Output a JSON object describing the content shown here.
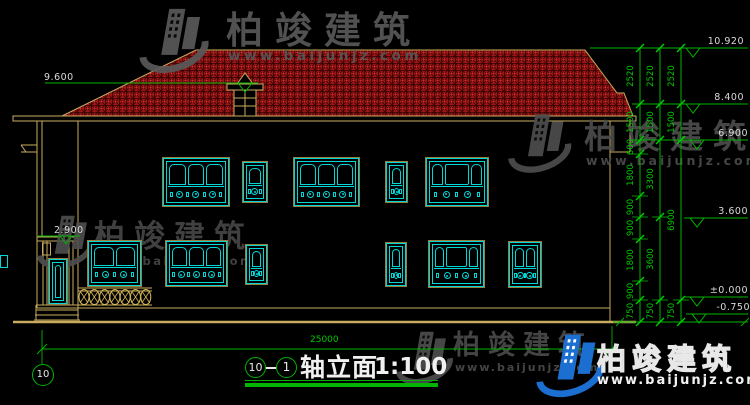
{
  "watermark": {
    "name": "柏竣建筑",
    "url": "www.baijunjz.com"
  },
  "title": {
    "axis_start": "10",
    "axis_end": "1",
    "name": "轴立面",
    "scale": "1:100"
  },
  "axis_bubble": "10",
  "bottom_dim": "25000",
  "colors": {
    "dim_green": "#00c800",
    "cyan": "#00d8d8",
    "tan": "#c8ab5e",
    "roof_red": "#9c1414",
    "wm_blue": "#1b6fd0"
  },
  "elevations_right": [
    {
      "label": "10.920",
      "x1": 680,
      "x2": 748,
      "y": 48
    },
    {
      "label": "8.400",
      "x1": 680,
      "x2": 748,
      "y": 104
    },
    {
      "label": "6.900",
      "x1": 684,
      "x2": 748,
      "y": 140
    },
    {
      "label": "3.600",
      "x1": 684,
      "x2": 748,
      "y": 218
    },
    {
      "label": "±0.000",
      "x1": 684,
      "x2": 748,
      "y": 297
    },
    {
      "label": "-0.750",
      "x1": 686,
      "x2": 748,
      "y": 314
    }
  ],
  "elevations_left": [
    {
      "label": "9.600",
      "x1": 45,
      "x2": 258,
      "y": 83,
      "tri": 238,
      "tx": 44,
      "tw": 14
    },
    {
      "label": "2.900",
      "x1": 38,
      "x2": 80,
      "y": 236,
      "tri": 60,
      "tx": 54,
      "tw": 12
    }
  ],
  "dim_columns": [
    {
      "x": 640,
      "boundaries": [
        48,
        104,
        140,
        154,
        196,
        217,
        239,
        281,
        300,
        322
      ],
      "labels": [
        "2520",
        "1500",
        "600",
        "1800",
        "900",
        "900",
        "1800",
        "900",
        "750"
      ]
    },
    {
      "x": 660,
      "boundaries": [
        48,
        104,
        140,
        217,
        300,
        322
      ],
      "labels": [
        "2520",
        "1500",
        "3300",
        "3600",
        "750"
      ]
    },
    {
      "x": 681,
      "boundaries": [
        48,
        104,
        140,
        300,
        322
      ],
      "labels": [
        "2520",
        "1500",
        "6900",
        "750"
      ]
    }
  ],
  "windows": [
    {
      "id": "u1",
      "style": "wide3",
      "x": 162,
      "y": 157,
      "w": 68,
      "h": 50
    },
    {
      "id": "u2",
      "style": "narrow",
      "x": 242,
      "y": 161,
      "w": 26,
      "h": 42
    },
    {
      "id": "u3",
      "style": "wide3",
      "x": 293,
      "y": 157,
      "w": 67,
      "h": 50
    },
    {
      "id": "u4",
      "style": "narrow",
      "x": 385,
      "y": 161,
      "w": 23,
      "h": 42
    },
    {
      "id": "u5",
      "style": "wideC",
      "x": 425,
      "y": 157,
      "w": 64,
      "h": 50
    },
    {
      "id": "l1",
      "style": "wide2",
      "x": 87,
      "y": 240,
      "w": 55,
      "h": 47
    },
    {
      "id": "l2",
      "style": "wide3",
      "x": 165,
      "y": 240,
      "w": 63,
      "h": 47
    },
    {
      "id": "l3",
      "style": "narrow",
      "x": 245,
      "y": 244,
      "w": 23,
      "h": 41
    },
    {
      "id": "l4",
      "style": "narrow",
      "x": 385,
      "y": 242,
      "w": 22,
      "h": 45
    },
    {
      "id": "l5",
      "style": "wideC",
      "x": 428,
      "y": 240,
      "w": 57,
      "h": 48
    },
    {
      "id": "l6",
      "style": "med2",
      "x": 508,
      "y": 241,
      "w": 34,
      "h": 47
    },
    {
      "id": "door",
      "style": "door",
      "x": 48,
      "y": 258,
      "w": 20,
      "h": 47
    },
    {
      "id": "frag",
      "style": "frag",
      "x": 0,
      "y": 255,
      "w": 8,
      "h": 13
    }
  ]
}
